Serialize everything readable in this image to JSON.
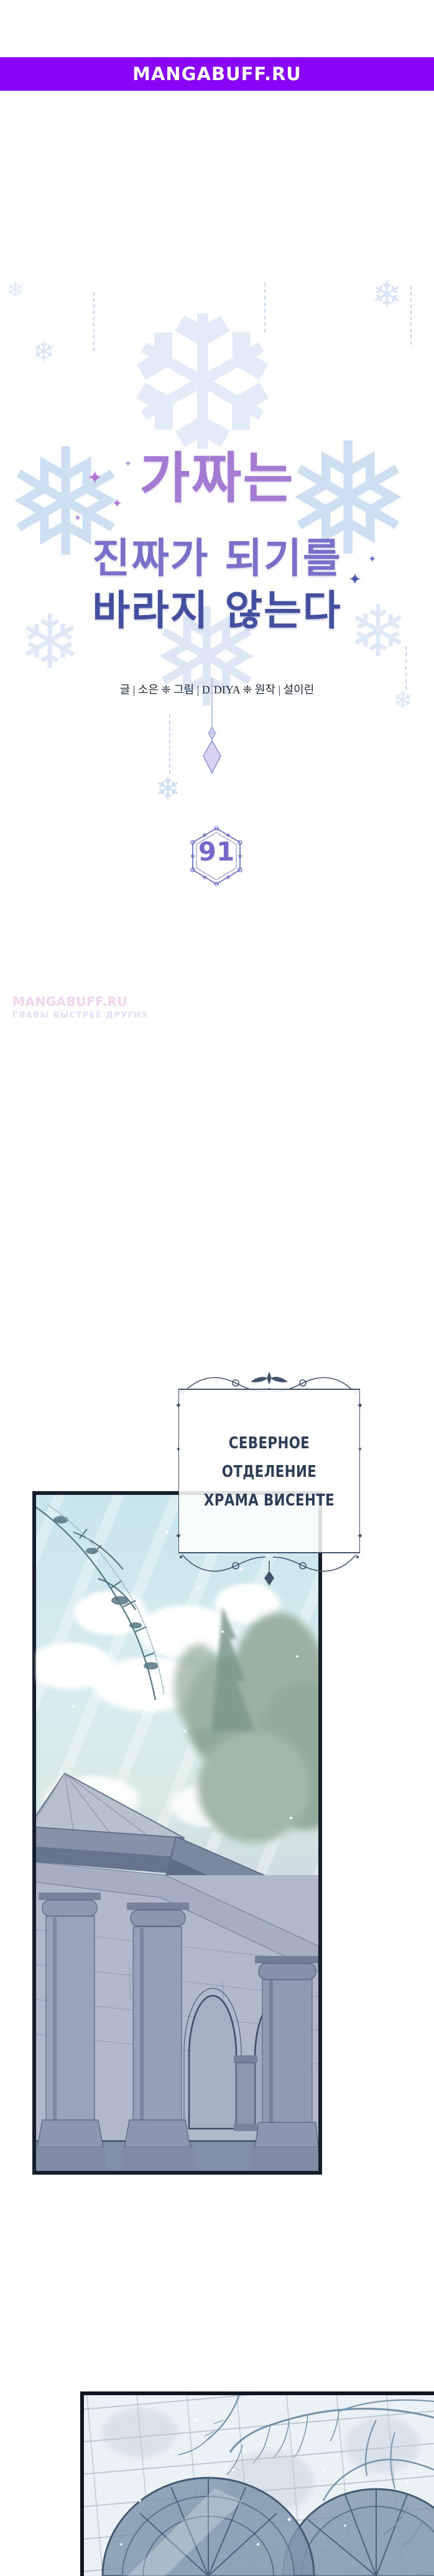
{
  "banner": {
    "label": "MANGABUFF.RU"
  },
  "title_art": {
    "line1": "가짜는",
    "line2": "진짜가 되기를",
    "line3": "바라지 않는다",
    "credits": "글 | 소은 ❈ 그림 | DIDIYA ❈ 원작 | 설이린",
    "chapter_number": "91"
  },
  "watermark": {
    "line1": "MANGABUFF.RU",
    "line2": "ГЛАВЫ БЫСТРЕЕ ДРУГИХ"
  },
  "caption": {
    "line1": "СЕВЕРНОЕ ОТДЕЛЕНИЕ",
    "line2": "ХРАМА ВИСЕНТЕ"
  },
  "icons": {
    "snowflake_large": "❅",
    "snowflake_crystal": "❆",
    "snowflake_small": "❄",
    "sparkle": "✦",
    "diamond": "◆"
  },
  "colors": {
    "banner_bg": "#8a05f7",
    "banner_text": "#ffffff",
    "title_purple": "#a47bd3",
    "title_blue": "#44509f",
    "snowflake_blue": "#cfdff2",
    "chapter_frame": "#5c64ba",
    "chapter_number": "#7a67cb",
    "watermark_pink": "#f3d4ee",
    "caption_ink": "#2e3d56",
    "panel_border": "#161d2b",
    "sky": "#c9e5eb",
    "stone": "#9aa5ba",
    "wall": "#ecf1f6"
  }
}
